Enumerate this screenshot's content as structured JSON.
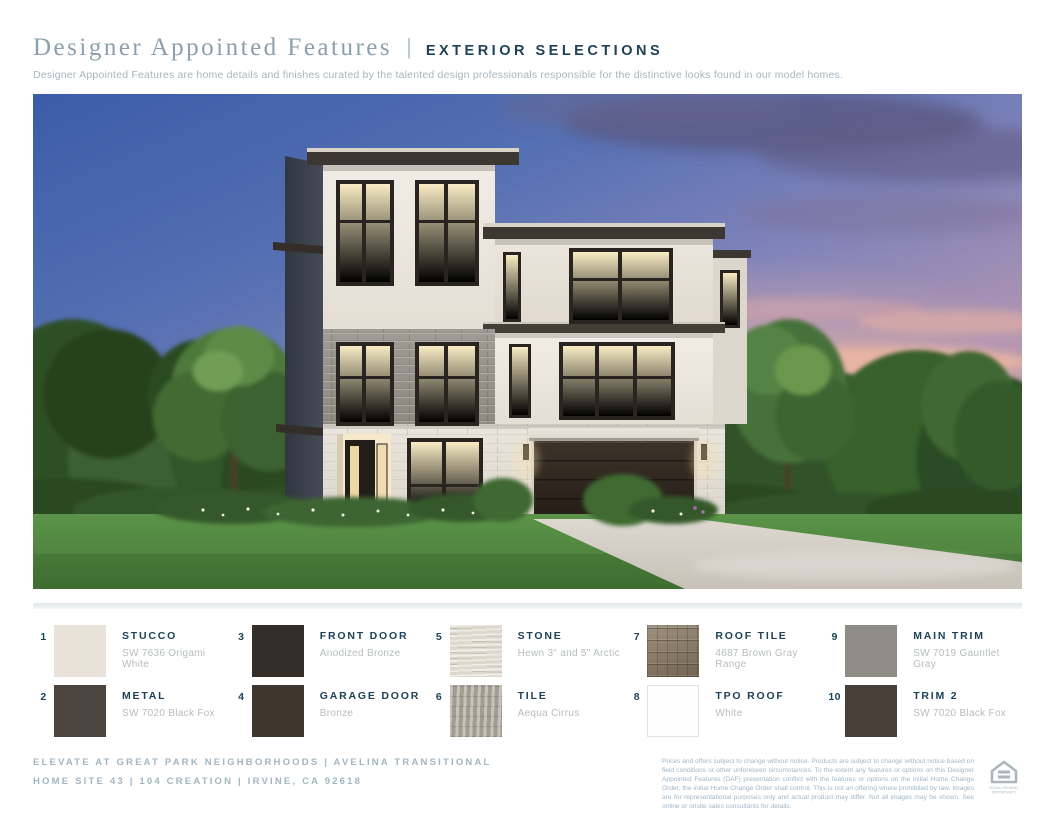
{
  "header": {
    "title": "Designer Appointed Features",
    "divider": "|",
    "section": "EXTERIOR SELECTIONS",
    "description": "Designer Appointed Features are home details and finishes curated by the talented design professionals responsible for the distinctive looks found in our model homes."
  },
  "colors": {
    "accent_navy": "#1d4156",
    "title_blue_gray": "#8ba0ac",
    "muted_label_gray": "#b6bcbf",
    "footer_blue_gray": "#a2b5c1"
  },
  "swatches": {
    "items": [
      {
        "num": "1",
        "name": "STUCCO",
        "desc": "SW 7636 Origami White",
        "color": "#e9e2d8"
      },
      {
        "num": "2",
        "name": "METAL",
        "desc": "SW 7020 Black Fox",
        "color": "#4b433d"
      },
      {
        "num": "3",
        "name": "FRONT DOOR",
        "desc": "Anodized Bronze",
        "color": "#352d28"
      },
      {
        "num": "4",
        "name": "GARAGE DOOR",
        "desc": "Bronze",
        "color": "#3f362e"
      },
      {
        "num": "5",
        "name": "STONE",
        "desc": "Hewn 3\" and 5\" Arctic",
        "color": "#ded7cb"
      },
      {
        "num": "6",
        "name": "TILE",
        "desc": "Aequa Cirrus",
        "color": "#b2aba0"
      },
      {
        "num": "7",
        "name": "ROOF TILE",
        "desc": "4687 Brown Gray Range",
        "color": "#8b7a64"
      },
      {
        "num": "8",
        "name": "TPO ROOF",
        "desc": "White",
        "color": "#fefefe"
      },
      {
        "num": "9",
        "name": "MAIN TRIM",
        "desc": "SW 7019 Gauntlet Gray",
        "color": "#8e8c84"
      },
      {
        "num": "10",
        "name": "TRIM 2",
        "desc": "SW 7020 Black Fox",
        "color": "#483f38"
      }
    ]
  },
  "footer": {
    "line1": "ELEVATE AT GREAT PARK NEIGHBORHOODS | AVELINA TRANSITIONAL",
    "line2": "HOME SITE 43 | 104 CREATION | IRVINE, CA 92618",
    "legal": "Prices and offers subject to change without notice. Products are subject to change without notice based on field conditions or other unforeseen circumstances. To the extent any features or options on this Designer Appointed Features (DAF) presentation conflict with the features or options on the initial Home Change Order, the initial Home Change Order shall control. This is not an offering where prohibited by law. Images are for representational purposes only and actual product may differ. Not all images may be shown. See online or onsite sales consultants for details.",
    "equal_housing": "EQUAL HOUSING OPPORTUNITY"
  }
}
